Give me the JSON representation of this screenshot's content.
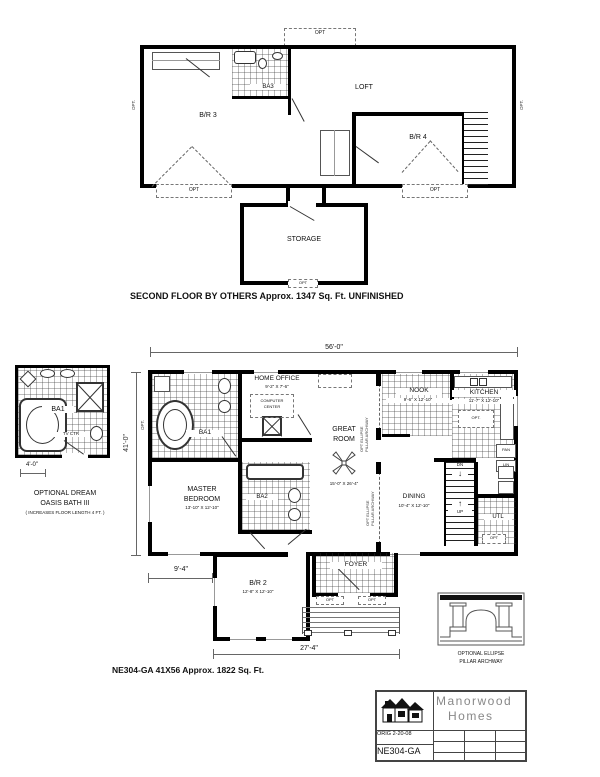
{
  "labels": {
    "opt": "OPT",
    "opt_dot": "OPT."
  },
  "icons": {
    "up_arrow": "↑",
    "down_arrow": "↓"
  },
  "second_floor": {
    "caption": "SECOND FLOOR BY OTHERS   Approx. 1347 Sq. Ft.  UNFINISHED",
    "rooms": {
      "br3": "B/R 3",
      "ba3": "BA3",
      "loft": "LOFT",
      "br4": "B/R 4",
      "storage": "STORAGE"
    }
  },
  "first_floor": {
    "caption": "NE304-GA  41X56  Approx. 1822 Sq. Ft.",
    "dims": {
      "overall_width": "56'-0\"",
      "overall_depth": "41'-0\"",
      "left_offset": "9'-4\"",
      "wing_width": "27'-4\""
    },
    "rooms": {
      "home_office": {
        "name": "HOME OFFICE",
        "size": "9'-2\" X 7'-6\"",
        "note1": "COMPUTER",
        "note2": "CENTER"
      },
      "ba1": "BA1",
      "great_room": {
        "name1": "GREAT",
        "name2": "ROOM",
        "size": "15'-0\" X 26'-4\""
      },
      "nook": {
        "name": "NOOK",
        "size": "9'-6\" X 12'-10\""
      },
      "kitchen": {
        "name": "KITCHEN",
        "size": "11'-7\" X 12'-10\""
      },
      "master": {
        "name1": "MASTER",
        "name2": "BEDROOM",
        "size": "13'-10\" X 12'-10\""
      },
      "ba2": "BA2",
      "dining": {
        "name": "DINING",
        "size": "10'-4\" X 12'-10\""
      },
      "utility": "UTL",
      "pantry": "PAN",
      "linen": "LIN",
      "br2": {
        "name": "B/R 2",
        "size": "12'-8\" X 12'-10\""
      },
      "foyer": "FOYER",
      "stairs_dn": "DN",
      "stairs_up": "UP"
    },
    "archway_note1": "OPT ELLIPSE",
    "archway_note2": "PILLAR ARCHWAY"
  },
  "inset_bath": {
    "room": "BA1",
    "tv": "TV CTR",
    "dim": "4'-0\"",
    "caption1": "OPTIONAL DREAM",
    "caption2": "OASIS BATH III",
    "caption3": "( INCREASES FLOOR LENGTH 4 FT. )"
  },
  "archway_detail": {
    "caption1": "OPTIONAL ELLIPSE",
    "caption2": "PILLAR ARCHWAY"
  },
  "title_block": {
    "brand1": "Manorwood",
    "brand2": "Homes",
    "orig": "ORIG 2-20-08",
    "model": "NE304-GA"
  }
}
